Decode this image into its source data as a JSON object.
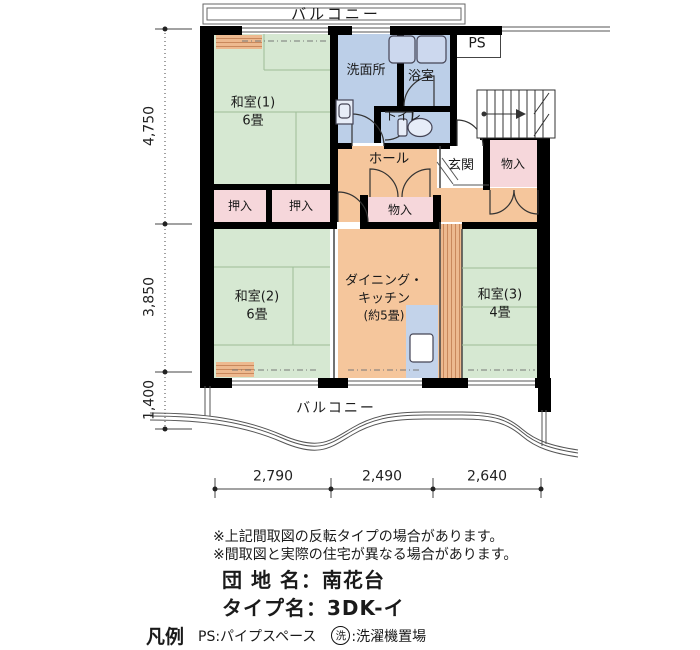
{
  "plan": {
    "balcony_top": "バルコニー",
    "balcony_bottom": "バルコニー",
    "ps": "PS",
    "rooms": {
      "washitsu1_name": "和室(1)",
      "washitsu1_size": "6畳",
      "washitsu2_name": "和室(2)",
      "washitsu2_size": "6畳",
      "washitsu3_name": "和室(3)",
      "washitsu3_size": "4畳",
      "dk_line1": "ダイニング・",
      "dk_line2": "キッチン",
      "dk_line3": "(約5畳)",
      "senmenjo": "洗面所",
      "bathroom": "浴室",
      "toilet": "トイレ",
      "hall": "ホール",
      "entrance": "玄関",
      "storage_right": "物入",
      "storage_center": "物入",
      "closet1": "押入",
      "closet2": "押入"
    },
    "dims": {
      "left_top": "4,750",
      "left_mid": "3,850",
      "left_bottom": "1,400",
      "bottom_left": "2,790",
      "bottom_mid": "2,490",
      "bottom_right": "2,640"
    }
  },
  "notes": {
    "line1": "※上記間取図の反転タイプの場合があります。",
    "line2": "※間取図と実際の住宅が異なる場合があります。"
  },
  "info": {
    "estate_label": "団 地 名：",
    "estate_value": "南花台",
    "type_label": "タイプ名：",
    "type_value": "3DK-イ"
  },
  "legend": {
    "title": "凡例",
    "ps_item": "PS:パイプスペース",
    "wash_mark": "洗",
    "wash_item": ":洗濯機置場"
  },
  "colors": {
    "tatami": "#d6e8d2",
    "wet": "#bccfe8",
    "wood": "#f5c69c",
    "closet": "#f6d7db",
    "stripeA": "#edb98f",
    "stripeB": "#c9885c",
    "wall": "#000000"
  }
}
